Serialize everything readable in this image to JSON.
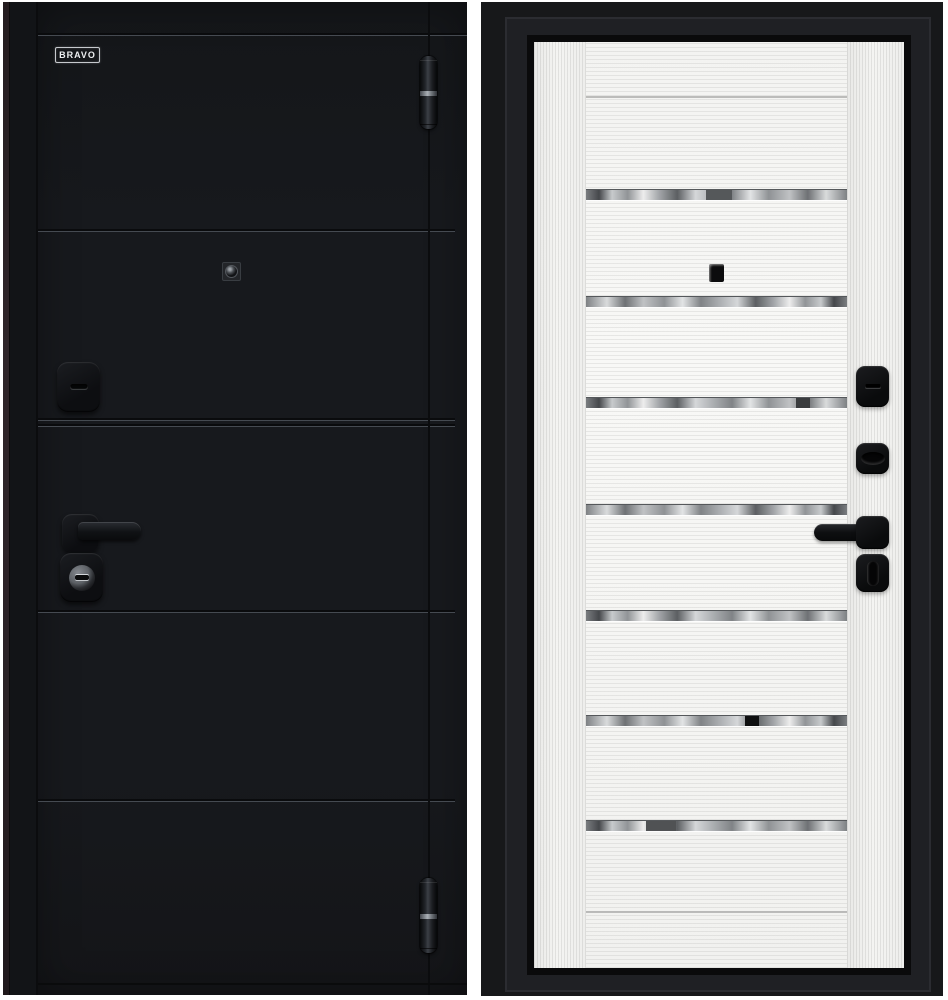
{
  "title": "Steel entrance door — exterior and interior panels",
  "brand": {
    "label": "BRAVO"
  },
  "panels": {
    "exterior": {
      "name": "exterior-black-panel",
      "finish_color": "#17191d",
      "groove_count": 5,
      "hardware": [
        "top-hinge",
        "peephole",
        "keyhole-escutcheon",
        "door-handle",
        "cylinder-lock",
        "bottom-hinge"
      ]
    },
    "interior": {
      "name": "interior-white-panel",
      "finish_color": "#f4f4f2",
      "frame_color": "#17181a",
      "glass_strip_count": 7,
      "hardware": [
        "peephole",
        "keyhole-escutcheon",
        "night-latch",
        "door-handle",
        "thumbturn-lock"
      ]
    }
  },
  "colors": {
    "background": "#ffffff",
    "exterior_black": "#17191d",
    "interior_white": "#f4f4f2",
    "frame_black": "#17181a",
    "chrome_silver": "#c9ccce",
    "edge_brown": "#2b2226",
    "hardware_black": "#0e0f11"
  }
}
